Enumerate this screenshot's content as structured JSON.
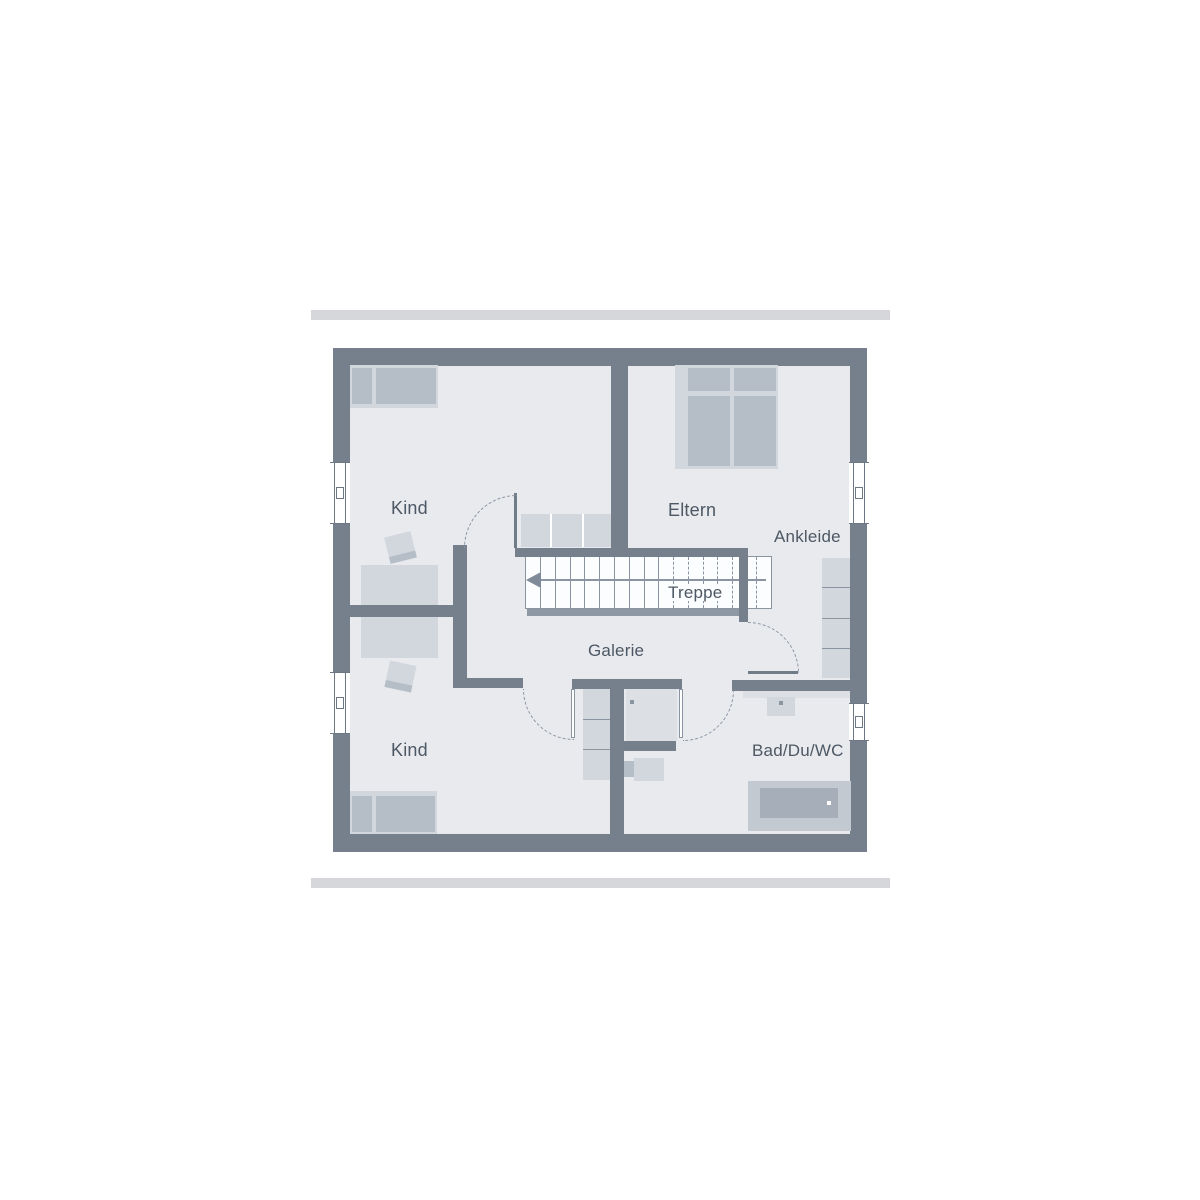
{
  "labels": {
    "room_kind_top": "Kind",
    "room_eltern": "Eltern",
    "room_ankleide": "Ankleide",
    "room_treppe": "Treppe",
    "room_galerie": "Galerie",
    "room_kind_bottom": "Kind",
    "room_bad": "Bad/Du/WC"
  },
  "stairs": {
    "direction": "left",
    "solid_steps": 9,
    "dashed_steps": 6
  },
  "colors": {
    "wall": "#76808D",
    "floor": "#E8EAEE",
    "furn_medium": "#B5BDC7",
    "furn_light": "#D2D7DD",
    "furn_pale": "#DCE0E5",
    "tub": "#A6AEB9",
    "platform": "#C3C9D1",
    "stair_fill": "#FCFDFE",
    "line": "#8B95A1",
    "door_line": "#717C89",
    "text": "#4D5864",
    "bar": "#D5D7DB",
    "handrail": "#8E98A4",
    "arrow": "#7E8A97",
    "window_frame": "#6E7885"
  }
}
